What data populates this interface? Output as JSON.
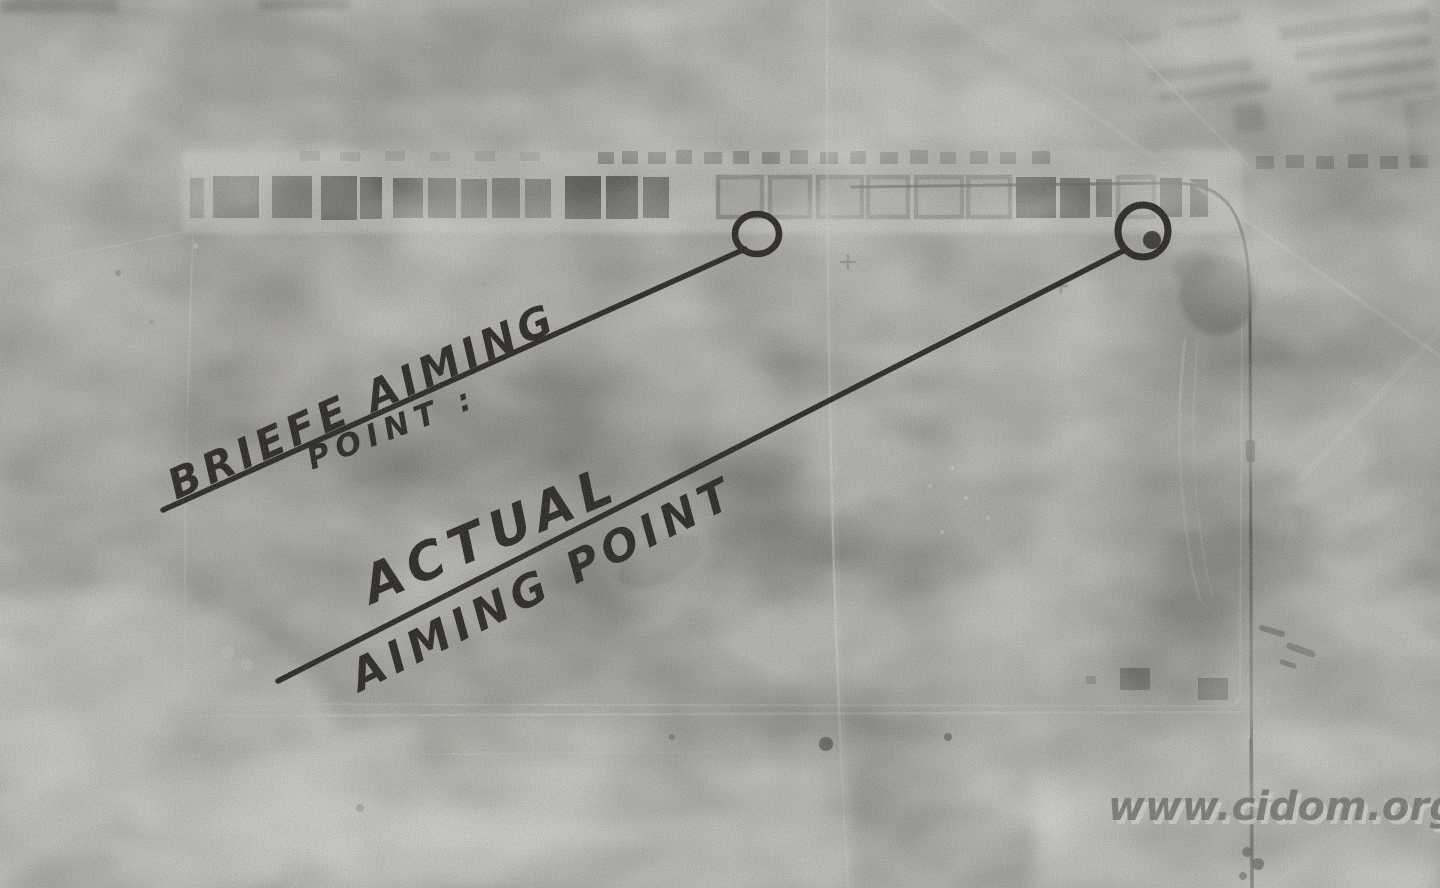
{
  "photo": {
    "annotations": {
      "briefed": {
        "line1": "BRIEFE AIMING",
        "line2": "POINT :"
      },
      "actual": {
        "line1": "ACTUAL",
        "line2": "AIMING POINT"
      }
    },
    "watermark": {
      "text": "www.cidom.org"
    },
    "colors": {
      "ink": "#17140f",
      "watermark_fill": "#636363",
      "watermark_shadow": "#d8d6ce"
    }
  }
}
